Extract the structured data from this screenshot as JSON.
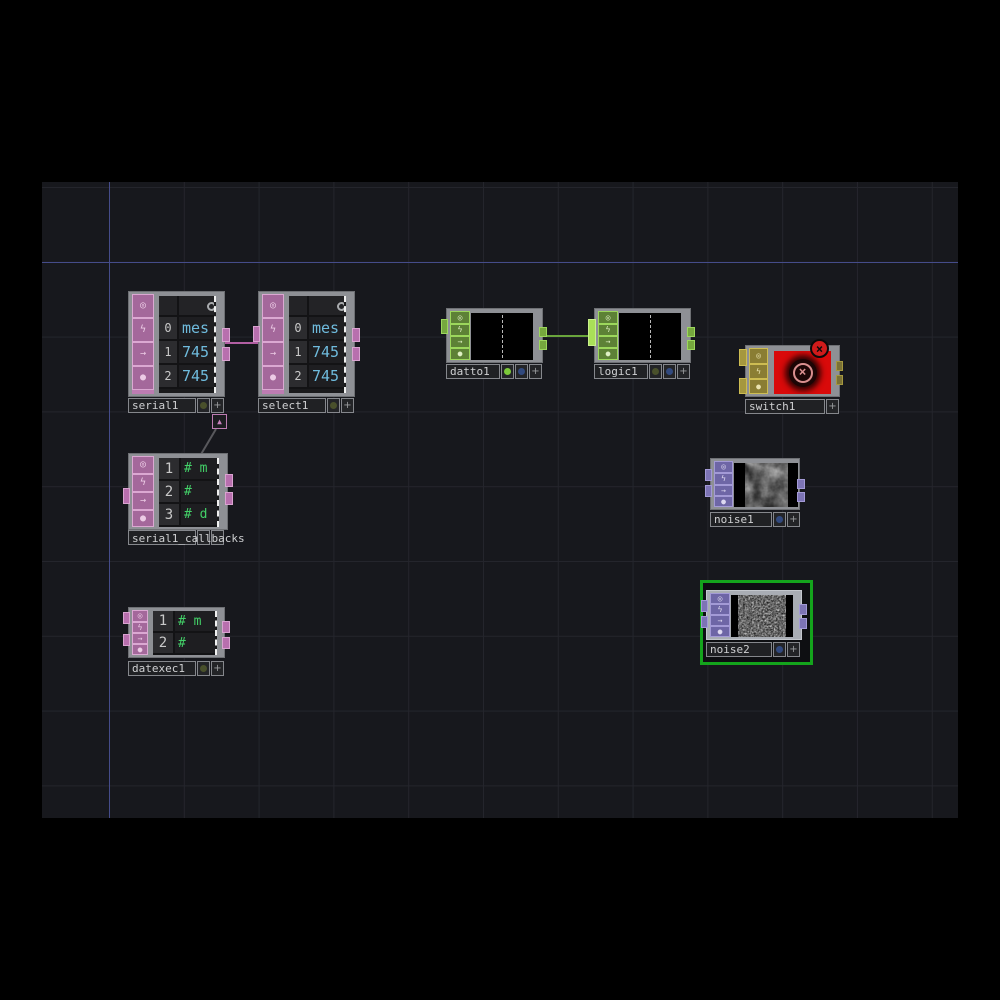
{
  "colors": {
    "dat_pink": "#bd7cb2",
    "chop_green": "#84c446",
    "top_purple": "#8b82c2",
    "switch_yellow": "#c4b34d",
    "selection_green": "#14a41c",
    "error_red": "#d90a0a",
    "wire_dat": "#b25fa3",
    "wire_chop": "#6aa53c",
    "wire_dock": "#58585c",
    "axis_accent": "#454c8a",
    "value_text": "#6fbbdd",
    "comment_text": "#43d168"
  },
  "icons": {
    "viewer_flag": "◎",
    "bypass_flag": "ϟ",
    "export_flag": "→",
    "cook_flag": "●",
    "plus": "+",
    "dock_arrow": "▲",
    "error_x": "×"
  },
  "nodes": {
    "serial1": {
      "label": "serial1",
      "rows": [
        {
          "n": "0",
          "v": "mes"
        },
        {
          "n": "1",
          "v": "745"
        },
        {
          "n": "2",
          "v": "745"
        }
      ]
    },
    "select1": {
      "label": "select1",
      "rows": [
        {
          "n": "0",
          "v": "mes"
        },
        {
          "n": "1",
          "v": "745"
        },
        {
          "n": "2",
          "v": "745"
        }
      ]
    },
    "serial1_callbacks": {
      "label": "serial1_callbacks",
      "rows": [
        {
          "n": "1",
          "v": "# m"
        },
        {
          "n": "2",
          "v": "#"
        },
        {
          "n": "3",
          "v": "# d"
        }
      ]
    },
    "datexec1": {
      "label": "datexec1",
      "rows": [
        {
          "n": "1",
          "v": "# m"
        },
        {
          "n": "2",
          "v": "#"
        }
      ]
    },
    "datto1": {
      "label": "datto1"
    },
    "logic1": {
      "label": "logic1"
    },
    "switch1": {
      "label": "switch1"
    },
    "noise1": {
      "label": "noise1"
    },
    "noise2": {
      "label": "noise2"
    }
  }
}
